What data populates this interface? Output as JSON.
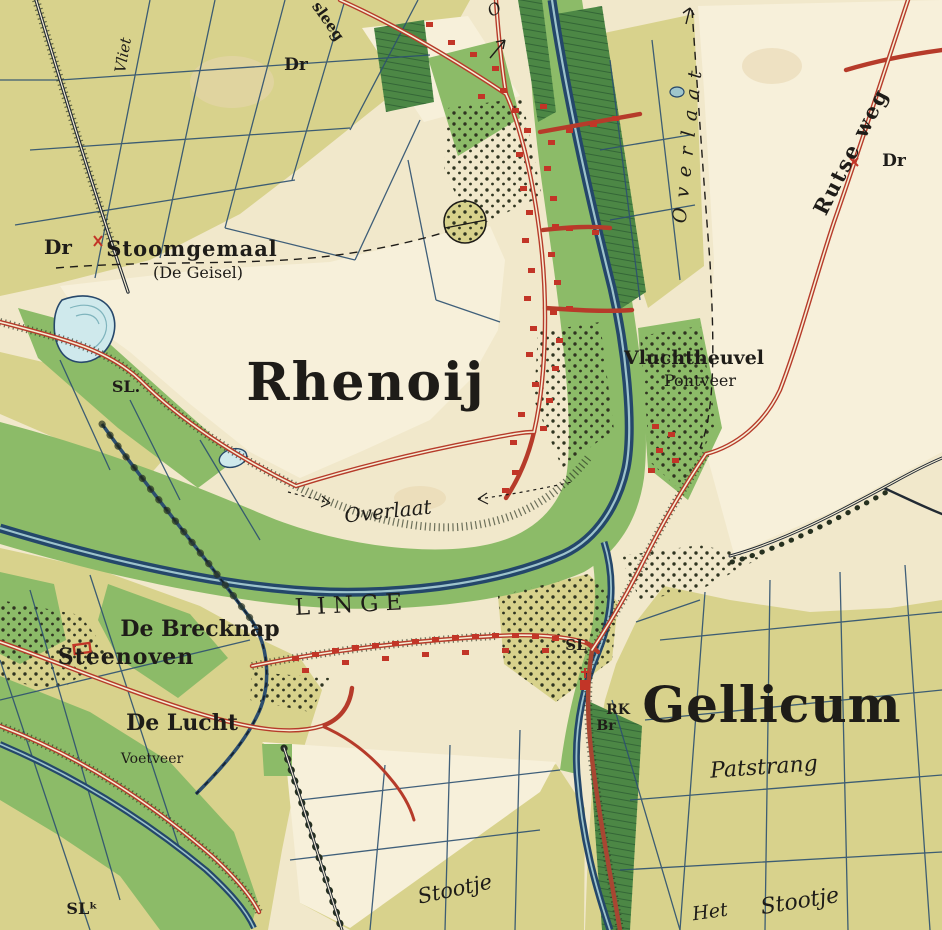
{
  "map": {
    "title": "Historical topographic map — Linge river, Rhenoij & Gellicum",
    "labels": {
      "rhenoij": "Rhenoij",
      "gellicum": "Gellicum",
      "dr_stoomgemaal": "Dr",
      "stoomgemaal": "Stoomgemaal",
      "stoomgemaal_sub": "(De Geisel)",
      "sl_left": "SL.",
      "overlaat_mid": "Overlaat",
      "linge": "LINGE",
      "de_brecknap": "De Brecknap",
      "steenoven": "Steenoven",
      "de_lucht": "De Lucht",
      "voetveer": "Voetveer",
      "patstrang": "Patstrang",
      "stootje_left": "Stootje",
      "het": "Het",
      "stootje_right": "Stootje",
      "vliet": "Vliet",
      "sleeg": "sleeg",
      "dr_top": "Dr",
      "overlaat_right": "Overlaat",
      "rutse_weg": "Rutse weg",
      "dr_right": "Dr",
      "vluchtheuvel": "Vluchtheuvel",
      "pontveer": "Pontveer",
      "sl_gellicum": "SL",
      "rk": "RK",
      "br": "Br",
      "sl_bottom": "SLᵏ",
      "o_frag": "O"
    },
    "palette": {
      "paper_cream": "#f1e8cb",
      "open_cream": "#f7f0da",
      "field_olive": "#d8d28c",
      "meadow_green": "#8cbb68",
      "plantation_green": "#4c8745",
      "water_blue": "#cfe9ec",
      "line_blue": "#2c5070",
      "river_navy": "#24476a",
      "road_red": "#b63b2a",
      "building_red": "#c23527",
      "ink_black": "#1e1c18"
    }
  }
}
